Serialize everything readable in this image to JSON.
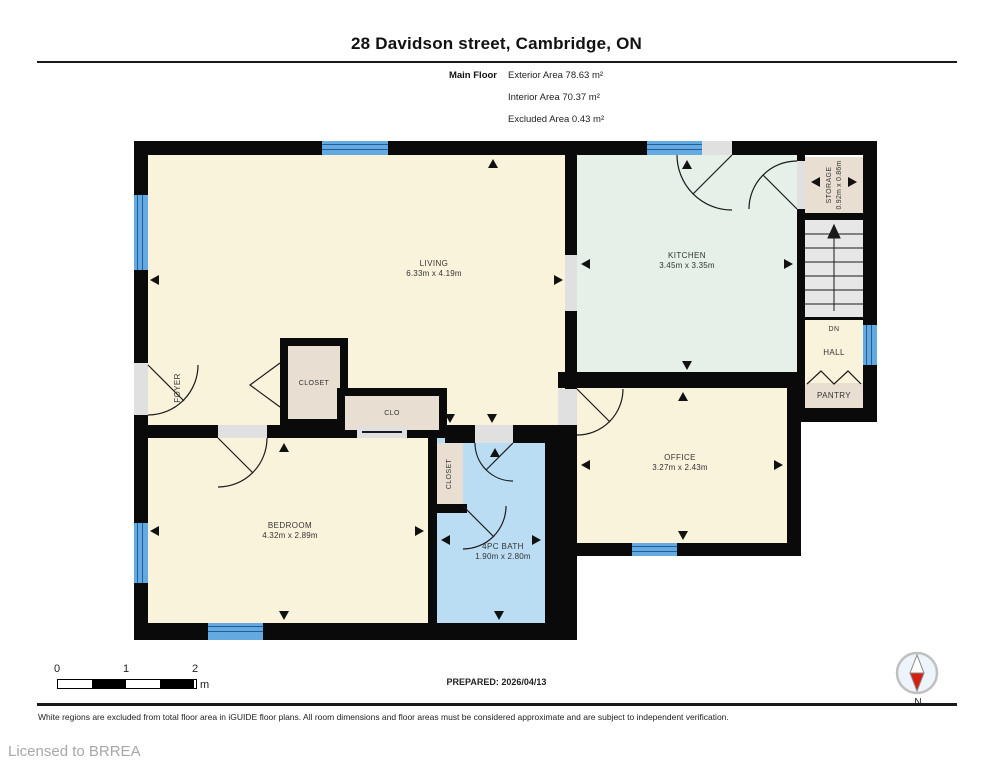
{
  "title": "28 Davidson street, Cambridge, ON",
  "floor_summary": {
    "floor_label": "Main Floor",
    "stats": [
      "Exterior Area 78.63 m²",
      "Interior Area 70.37 m²",
      "Excluded Area 0.43 m²"
    ]
  },
  "rooms": {
    "living": {
      "name": "LIVING",
      "dims": "6.33m x 4.19m"
    },
    "kitchen": {
      "name": "KITCHEN",
      "dims": "3.45m x 3.35m"
    },
    "office": {
      "name": "OFFICE",
      "dims": "3.27m x 2.43m"
    },
    "bedroom": {
      "name": "BEDROOM",
      "dims": "4.32m x 2.89m"
    },
    "bath": {
      "name": "4PC BATH",
      "dims": "1.90m x 2.80m"
    },
    "storage": {
      "name": "STORAGE",
      "dims": "0.92m x 0.86m"
    },
    "foyer": {
      "name": "FOYER"
    },
    "closet": {
      "name": "CLOSET"
    },
    "clo": {
      "name": "CLO"
    },
    "bath_closet": {
      "name": "CLOSET"
    },
    "hall": {
      "name": "HALL"
    },
    "dn": {
      "name": "DN"
    },
    "pantry": {
      "name": "PANTRY"
    }
  },
  "scale_bar": {
    "labels": [
      "0",
      "1",
      "2"
    ],
    "unit": "m"
  },
  "prepared": "PREPARED: 2026/04/13",
  "disclaimer": "White regions are excluded from total floor area in iGUIDE floor plans. All room dimensions and floor areas must be considered approximate and are subject to independent verification.",
  "license": "Licensed to BRREA",
  "compass": {
    "label": "N"
  },
  "colors": {
    "wall": "#0a0a0a",
    "cream": "#faf3dc",
    "mint": "#e4f0e8",
    "bathblue": "#bbddf3",
    "beige": "#e8dfd2",
    "stairgray": "#e7e7e7",
    "opening": "#e0e0e0",
    "window": "#64aae0",
    "windowline": "#1f5f9e",
    "compassred": "#d32011"
  }
}
